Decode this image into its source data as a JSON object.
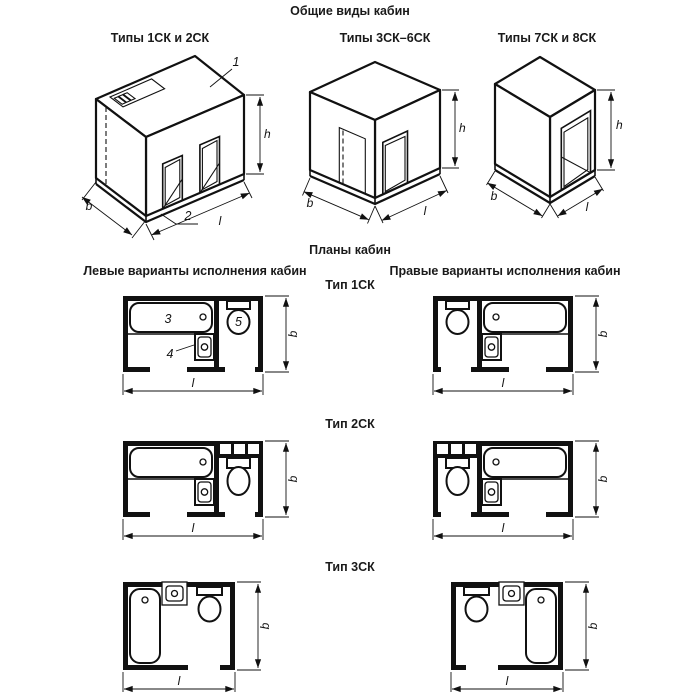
{
  "title": "Общие виды кабин",
  "sections": {
    "plans_title": "Планы кабин",
    "left_column_header": "Левые варианты исполнения кабин",
    "right_column_header": "Правые варианты исполнения кабин"
  },
  "iso_views": [
    {
      "label": "Типы 1СК и 2СК"
    },
    {
      "label": "Типы 3СК–6СК"
    },
    {
      "label": "Типы 7СК и 8СК"
    }
  ],
  "plan_types": [
    {
      "label": "Тип 1СК"
    },
    {
      "label": "Тип 2СК"
    },
    {
      "label": "Тип 3СК"
    }
  ],
  "dim_labels": {
    "h": "h",
    "b": "b",
    "l": "l"
  },
  "callouts": {
    "roof": "1",
    "base": "2",
    "bathtub": "3",
    "washbasin": "4",
    "toilet": "5"
  }
}
